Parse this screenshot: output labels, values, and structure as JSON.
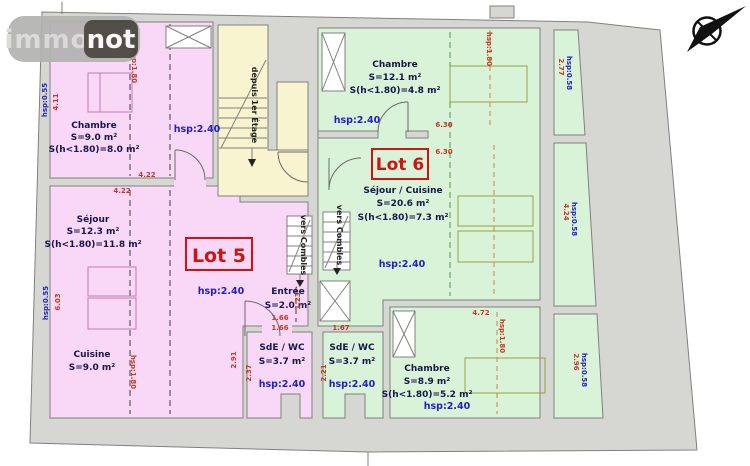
{
  "logo": {
    "part1": "immo",
    "part2": "not"
  },
  "lot5": {
    "label": "Lot 5"
  },
  "lot6": {
    "label": "Lot 6"
  },
  "rooms": {
    "chambre_nw": {
      "name": "Chambre",
      "area": "S=9.0 m²",
      "area_low": "S(h<1.80)=8.0 m²",
      "height": "hsp:2.40"
    },
    "sejour": {
      "name": "Séjour",
      "area": "S=12.3 m²",
      "area_low": "S(h<1.80)=11.8 m²",
      "height": "hsp:2.40"
    },
    "cuisine": {
      "name": "Cuisine",
      "area": "S=9.0 m²"
    },
    "entree": {
      "name": "Entrée",
      "area": "S=2.0 m²"
    },
    "sde_wc_lot5": {
      "name": "SdE / WC",
      "area": "S=3.7 m²",
      "height": "hsp:2.40"
    },
    "sde_wc_lot6": {
      "name": "SdE / WC",
      "area": "S=3.7 m²",
      "height": "hsp:2.40"
    },
    "chambre_ne": {
      "name": "Chambre",
      "area": "S=12.1 m²",
      "area_low": "S(h<1.80)=4.8 m²",
      "height": "hsp:2.40"
    },
    "sejour_cuisine": {
      "name": "Séjour / Cuisine",
      "area": "S=20.6 m²",
      "area_low": "S(h<1.80)=7.3 m²",
      "height": "hsp:2.40"
    },
    "chambre_se": {
      "name": "Chambre",
      "area": "S=8.9 m²",
      "area_low": "S(h<1.80)=5.2 m²",
      "height": "hsp:2.40"
    }
  },
  "stairs": {
    "from_first_floor": "depuis 1er Étage",
    "to_attic_left": "vers Combles",
    "to_attic_right": "vers Combles"
  },
  "dimensions": {
    "d411": "4.11",
    "d422a": "4.22",
    "d422b": "4.22",
    "d603": "6.03",
    "d291": "2.91",
    "d166a": "1.66",
    "d166b": "1.66",
    "d167": "1.67",
    "d123": "1.23",
    "d237": "2.37",
    "d221": "2.21",
    "d630a": "6.30",
    "d630b": "6.30",
    "d472": "4.72",
    "d277": "2.77",
    "d424": "4.24",
    "d296": "2.96"
  },
  "height_marks": {
    "hsp055a": "hsp:0.55",
    "hsp055b": "hsp:0.55",
    "hsp180_nw": "hsp:1.80",
    "hsp180_sw": "hsp:1.80",
    "hsp180_ne": "hsp:1.80",
    "hsp180_se": "hsp:1.80",
    "hsp058a": "hsp:0.58",
    "hsp058b": "hsp:0.58",
    "hsp058c": "hsp:0.58"
  },
  "colors": {
    "lot5_fill": "#f9d8f7",
    "lot6_fill": "#d9f3d9",
    "stair_fill": "#f8f4d0",
    "wall_gray": "#d6d6d3",
    "dim_red": "#c23a28",
    "label_blue": "#2121c0",
    "room_text": "#16164a",
    "lot_red": "#cf1313"
  }
}
